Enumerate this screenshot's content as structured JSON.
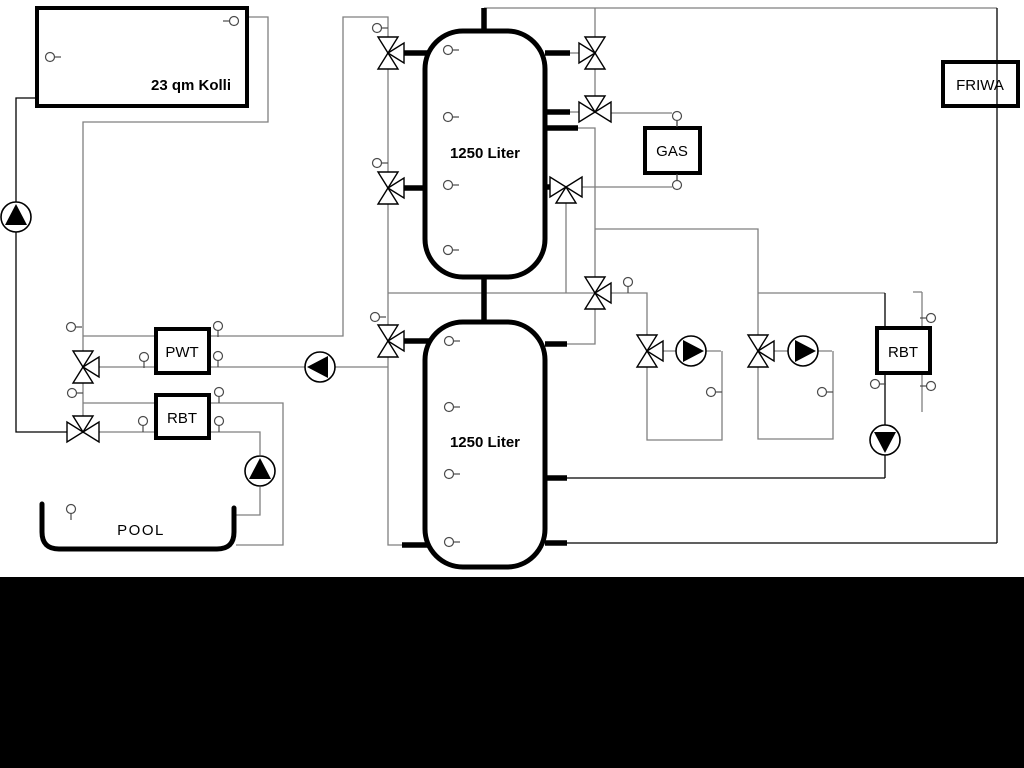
{
  "window": {
    "background": "#ffffff",
    "footer_band_color": "#000000"
  },
  "colors": {
    "pipe_gray": "#7f7f7f",
    "pipe_black": "#000000",
    "equipment_outline": "#000000"
  },
  "labels": {
    "collector": "23 qm Kolli",
    "buffer_tank_top": "1250 Liter",
    "buffer_tank_bottom": "1250 Liter",
    "pwt": "PWT",
    "rbt_pool": "RBT",
    "pool": "POOL",
    "gas": "GAS",
    "friwa": "FRIWA",
    "rbt_dhw": "RBT"
  }
}
